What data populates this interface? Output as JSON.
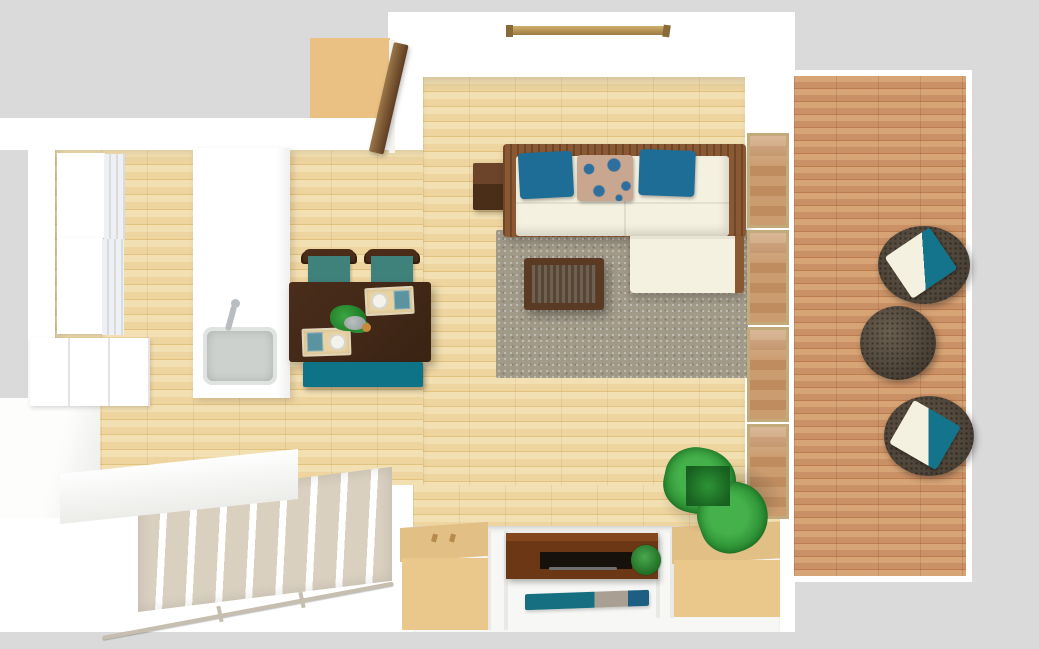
{
  "scene": {
    "type": "3d-floorplan-top-down-render",
    "description": "Top-down 3D render of a studio apartment: kitchen with island sink, dining set with teal seats, L-shaped white sofa with blue pillows on a taupe rug, slatted coffee table, sliding glass doors to a wood balcony deck with two rattan chairs and round rattan table, genkan entryway with shoe cabinets, sideboard, striped doormat and potted plants, and a descending staircase.",
    "rooms": [
      "living-dining-kitchen",
      "balcony-deck",
      "entryway",
      "staircase",
      "entry-porch"
    ]
  },
  "inventory": {
    "kitchen": [
      "wall-cabinet-upper",
      "wall-cabinet-lower",
      "glass-display-shelves",
      "base-cabinet",
      "island-counter",
      "sink-with-faucet"
    ],
    "dining": [
      "dark-wood-table",
      "chair-with-teal-seat x2",
      "teal-bench",
      "place-setting x2",
      "centerpiece-plant",
      "fruit"
    ],
    "living": [
      "l-shaped-sofa",
      "teal-pillow x2",
      "floral-pillow",
      "side-table",
      "slatted-coffee-table",
      "taupe-area-rug",
      "curtain-rail"
    ],
    "entry": [
      "open-front-door",
      "entry-porch",
      "shoe-cabinet-left",
      "shoe-cabinet-right",
      "low-sideboard",
      "striped-doormat",
      "potted-plant-large x2",
      "small-round-plant"
    ],
    "balcony": [
      "rattan-chair-with-cushion x2",
      "round-rattan-table",
      "sliding-glass-door-4-panels"
    ],
    "stairs": [
      "descending-staircase",
      "handrail",
      "upper-landing"
    ]
  },
  "palette": {
    "bg": "#dadada",
    "wall": "#ffffff",
    "floorBase": "#eed5a0",
    "floorLight": "#f3e0b2",
    "floorDark": "#e2c27f",
    "deckBase": "#cb9166",
    "deckLight": "#d7a476",
    "deckDark": "#bd7c4f",
    "tanPanel": "#eac183",
    "tanTop": "#e2bf85",
    "tanFront": "#eac88c",
    "tanMat": "#e8d2a2",
    "espresso": "#44291a",
    "seatTeal": "#3f817b",
    "benchTeal": "#0e7387",
    "pillowBlue": "#1d6d96",
    "floralBase": "#c9a68f",
    "floralBlue": "#2f6f9e",
    "ivory": "#f5f1e0",
    "sofaWood": "#8a5832",
    "rugTaupe": "#a29a89",
    "wicker": "#4a4136",
    "wickerDark": "#453c32",
    "cushionTeal": "#14748c",
    "stepBeige": "#d9d0c0",
    "railBeige": "#c6beae",
    "shelfBlack": "#17110c",
    "potClay": "#7a3c1e",
    "matTeal": "#156f80",
    "matGray": "#a9a093",
    "matBlue": "#1d5f82",
    "sinkGray": "#cdd1cd",
    "steel": "#b9bdbf",
    "beamWood": "#cfae6c",
    "doorFrameTan": "#c3aa7a",
    "doorLeafLight": "#9a7648",
    "doorLeafDark": "#5f3d22",
    "plateWhite": "#f4f2ec",
    "napkinBlue": "#5b93a0",
    "fruitOrange": "#c8893c"
  }
}
